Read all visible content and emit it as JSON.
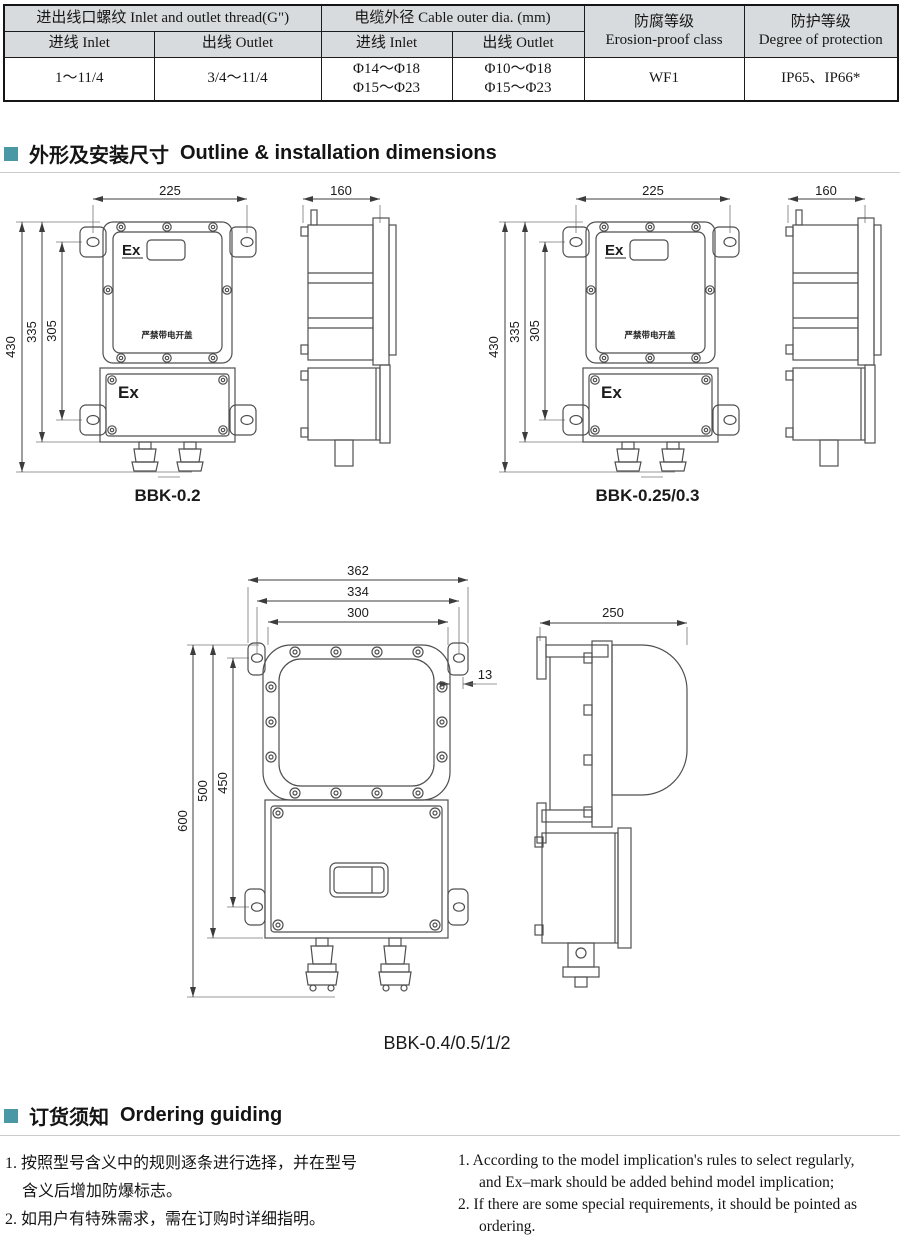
{
  "table": {
    "header_bg": "#d8dbdd",
    "group_thread": "进出线口螺纹 Inlet and outlet thread(G\")",
    "group_cable": "电缆外径 Cable outer dia. (mm)",
    "erosion_zh": "防腐等级",
    "erosion_en": "Erosion-proof class",
    "protection_zh": "防护等级",
    "protection_en": "Degree of protection",
    "subheaders": [
      "进线 Inlet",
      "出线 Outlet",
      "进线 Inlet",
      "出线 Outlet"
    ],
    "values": {
      "thread_inlet": "1～11/4",
      "thread_outlet": "3/4～11/4",
      "cable_inlet_line1": "Φ14～Φ18",
      "cable_inlet_line2": "Φ15～Φ23",
      "cable_outlet_line1": "Φ10～Φ18",
      "cable_outlet_line2": "Φ15～Φ23",
      "erosion": "WF1",
      "protection": "IP65、IP66*"
    }
  },
  "sections": {
    "bullet_color": "#4a98a6",
    "outline": {
      "zh": "外形及安装尺寸",
      "en": "Outline & installation dimensions"
    },
    "ordering": {
      "zh": "订货须知",
      "en": "Ordering guiding"
    }
  },
  "drawings": {
    "ex_mark": "Ex",
    "warning_plate": "严禁带电开盖",
    "front_small": {
      "width": "225",
      "height_total": "430",
      "height_body": "335",
      "hole_span": "305"
    },
    "side_small": {
      "depth": "160"
    },
    "front_big": {
      "width_total": "362",
      "hole_span": "334",
      "cover_span": "300",
      "lug_offset": "13",
      "height_total": "600",
      "height_body": "500",
      "hole_span_v": "450"
    },
    "side_big": {
      "depth": "250"
    },
    "labels": {
      "small_left": "BBK-0.2",
      "small_right": "BBK-0.25/0.3",
      "big": "BBK-0.4/0.5/1/2"
    }
  },
  "ordering_notes": {
    "zh": [
      "1. 按照型号含义中的规则逐条进行选择，并在型号",
      "含义后增加防爆标志。",
      "2. 如用户有特殊需求，需在订购时详细指明。"
    ],
    "en": [
      "1. According to the model implication's rules to select regularly,",
      "and Ex–mark should be added behind model implication;",
      "2. If there are some special requirements, it should be pointed as",
      "ordering."
    ]
  }
}
